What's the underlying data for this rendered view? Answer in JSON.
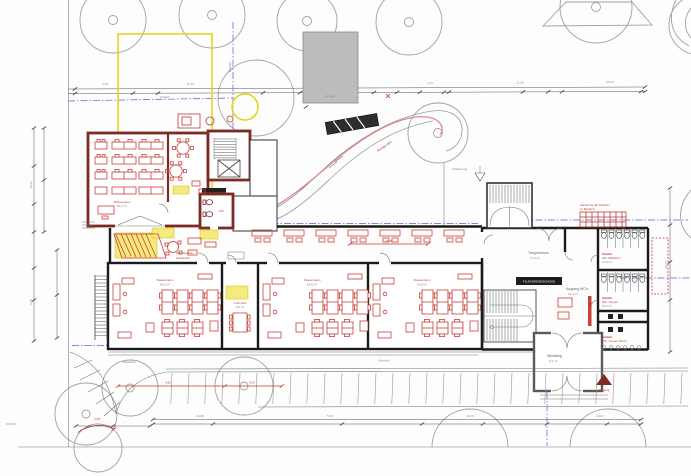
{
  "colors": {
    "wall_new": "#7d2b22",
    "wall_existing": "#1b1b1b",
    "furniture_red": "#c9403a",
    "highlight_yellow": "#f4ea7d",
    "boundary_blue": "#5b5bd6",
    "dimension_red": "#c03a32",
    "site_gray": "#a0a0a0",
    "existing_building_fill": "#bcbcbc"
  },
  "site": {
    "zufahrt": "Zufahrt",
    "grenze": "Grenze",
    "bestand": "Garage",
    "rampe": "Rampe 6%",
    "zugang": "Anlieferung",
    "schulhof": "Schulhof",
    "stellplaetze": "Stellplätze",
    "eingang": "Eingang"
  },
  "rooms": {
    "klassenraum": "Klassenraum",
    "area0": "60,2 m²",
    "area1": "66,5 m²",
    "area2": "64,8 m²",
    "area3": "64,8 m²",
    "treppenhaus": "Treppenhaus",
    "treppenhaus_area": "17,6 m²",
    "aufgang": "Aufgang WC's",
    "aufgang_area": "23,4 m²",
    "windfang": "Windfang",
    "windfang_area": "9,2 m²",
    "wc_tag": "Sanitär",
    "wc_m": "WC, Mädchen",
    "wc_m_area": "16,8 m²",
    "wc_j": "WC, Jungen",
    "wc_j_area": "16,2 m²",
    "wc_p": "WC, Jungen (Pers.)",
    "wc_small": "WC",
    "lehrmittel": "Lehrmittel",
    "lehrmittel_area": "8,6 m²",
    "garderobe": "Garderobe",
    "wartebereich": "Wartebereich",
    "corridor_sign": "FLUR ERDGESCHOSS",
    "sanierung1": "Sanierung der Toiletten",
    "sanierung2": "im Bestand"
  },
  "dims": {
    "top": [
      "3,38",
      "12,49",
      "4,99",
      "2,51",
      "11,26",
      "26,44"
    ],
    "bottom": [
      "24,38",
      "5,00",
      "11,26",
      "24,01"
    ],
    "left": [
      "12,51",
      "9,38"
    ],
    "right": [
      "15,24"
    ],
    "red": [
      "4,50",
      "9,00",
      "27,45"
    ],
    "red_small": "4,50"
  }
}
